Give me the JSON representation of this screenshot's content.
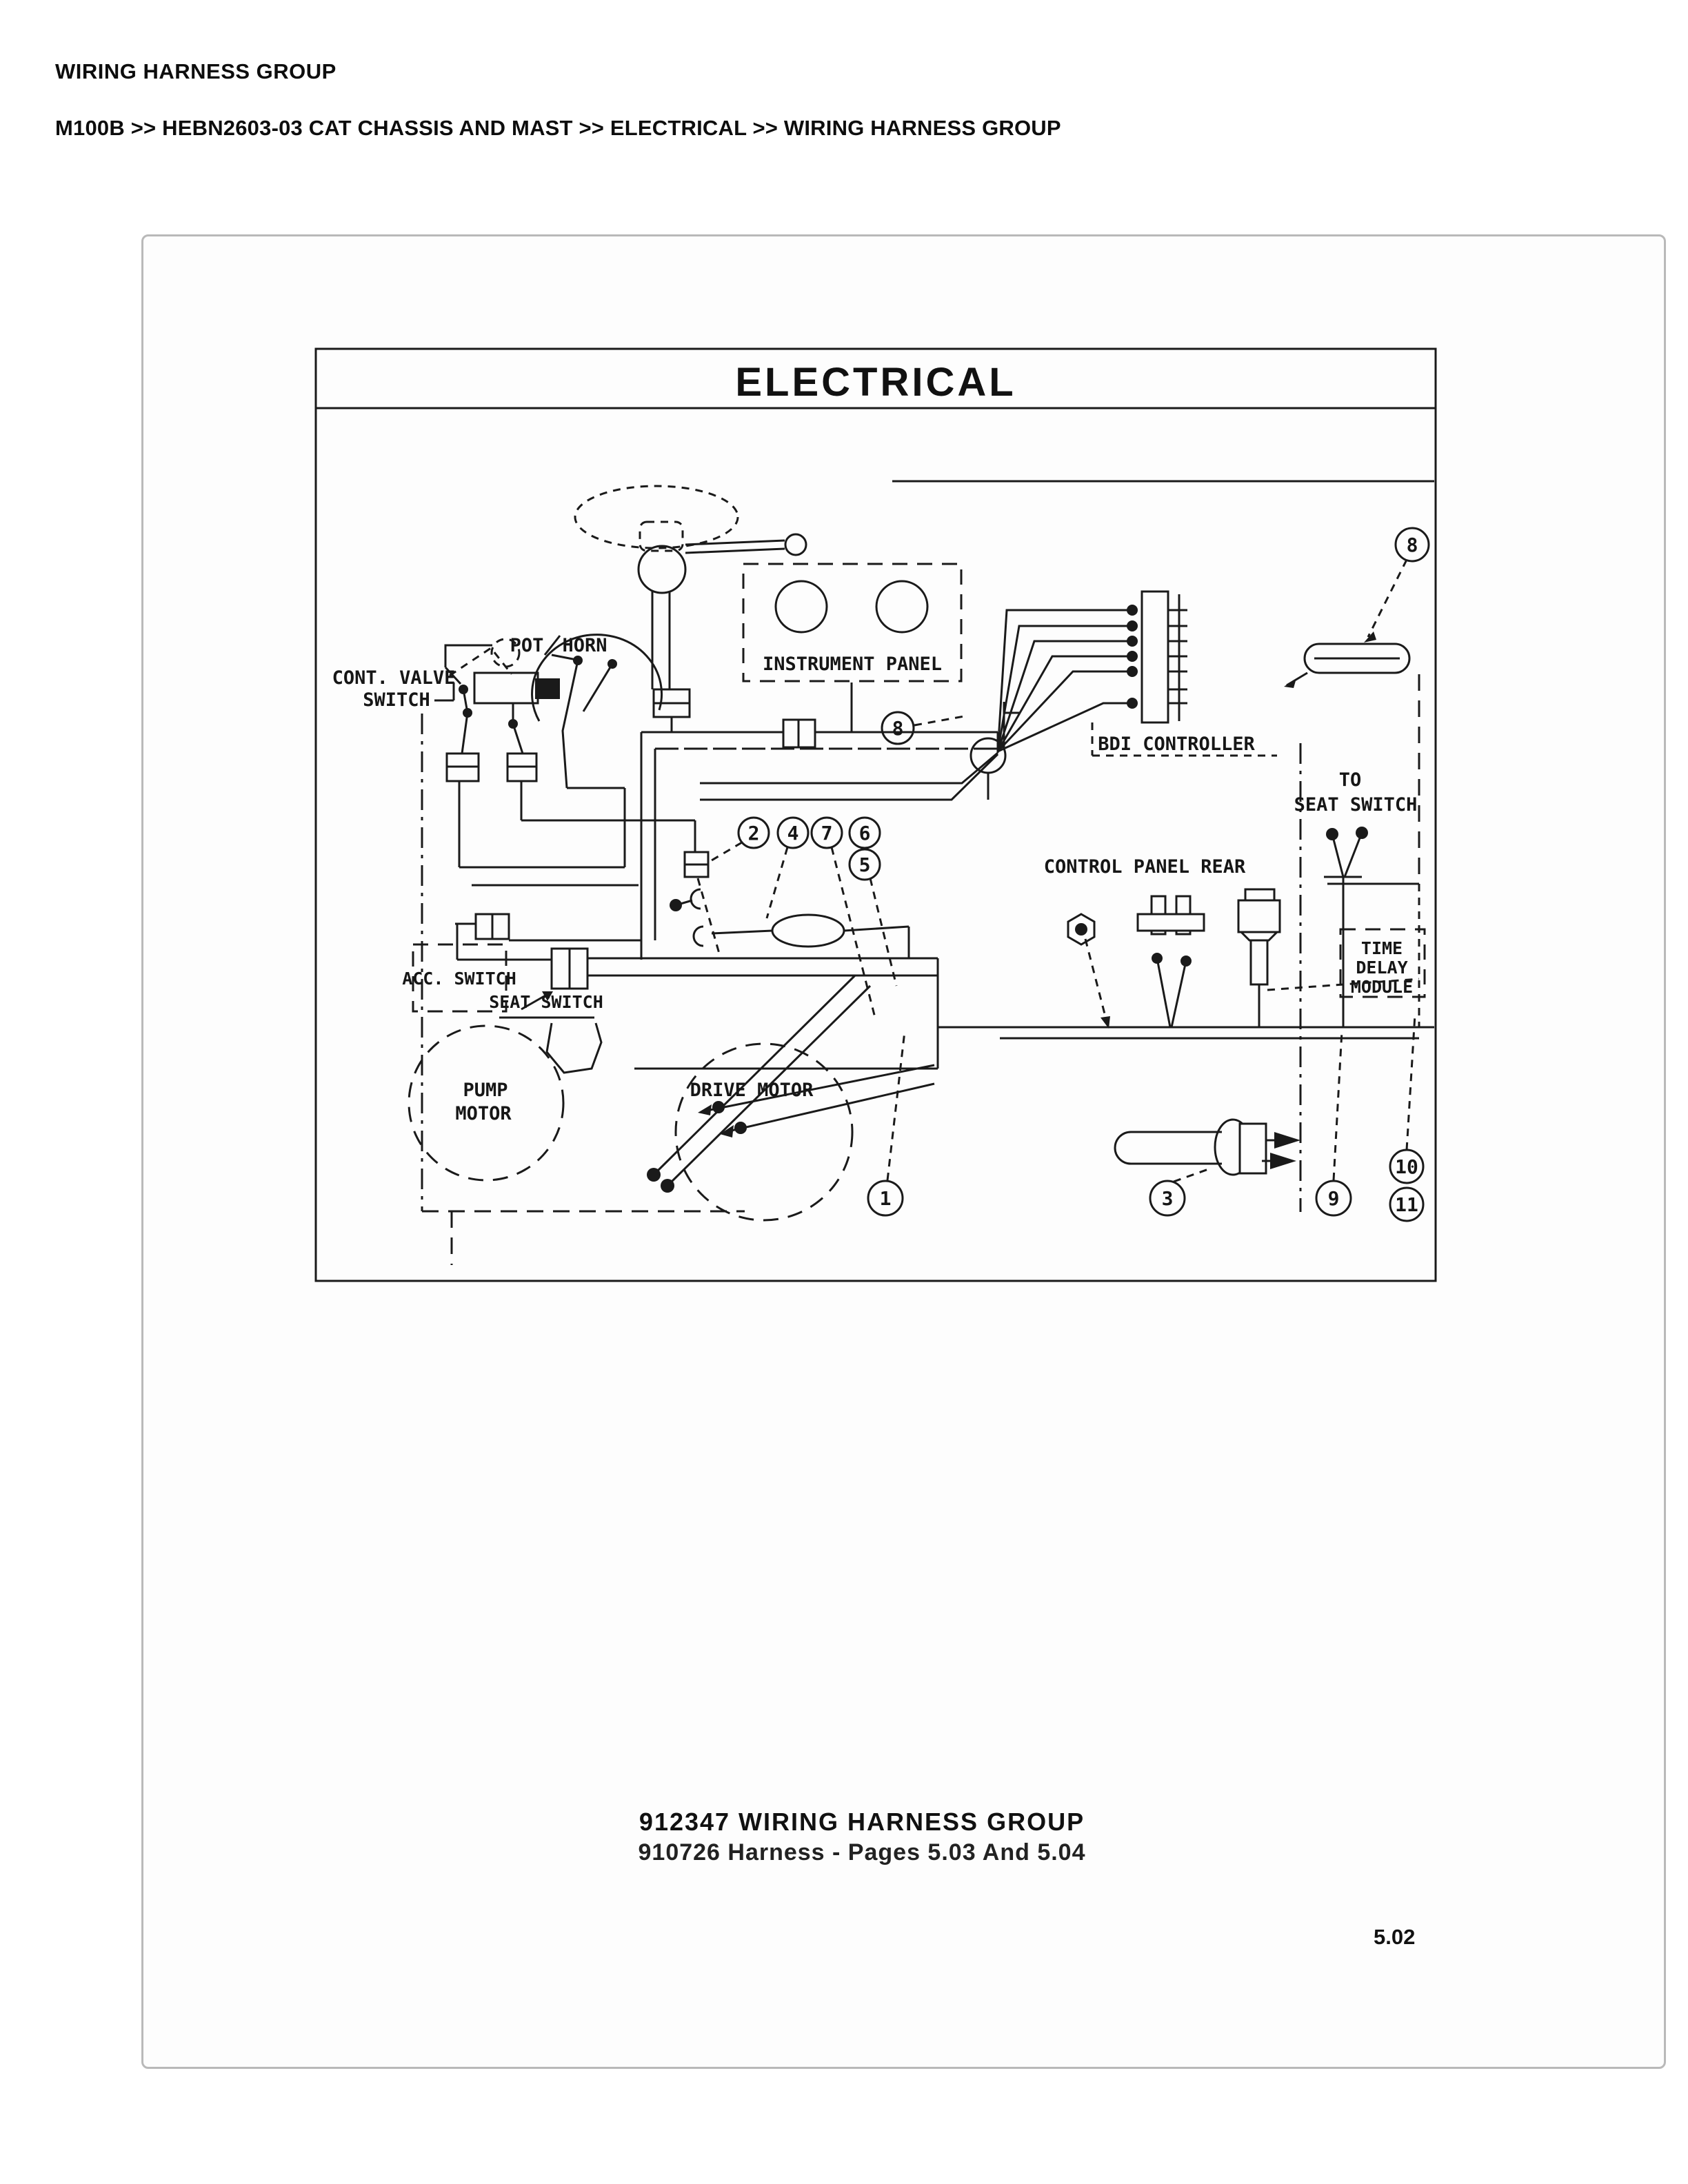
{
  "header": {
    "title": "WIRING HARNESS GROUP",
    "breadcrumb": "M100B >> HEBN2603-03 CAT CHASSIS AND MAST >> ELECTRICAL >> WIRING HARNESS GROUP"
  },
  "diagram": {
    "title": "ELECTRICAL",
    "labels": {
      "pot": "POT",
      "horn": "HORN",
      "cont_valve_1": "CONT. VALVE",
      "cont_valve_2": "SWITCH",
      "instrument_panel": "INSTRUMENT PANEL",
      "bdi_controller": "BDI CONTROLLER",
      "control_panel_rear": "CONTROL PANEL REAR",
      "to_seat_1": "TO",
      "to_seat_2": "SEAT SWITCH",
      "time_delay_1": "TIME",
      "time_delay_2": "DELAY",
      "time_delay_3": "MODULE",
      "acc_switch": "ACC. SWITCH",
      "seat_switch": "SEAT SWITCH",
      "pump_1": "PUMP",
      "pump_2": "MOTOR",
      "drive_motor": "DRIVE MOTOR"
    },
    "callouts": {
      "c1": "1",
      "c2": "2",
      "c3": "3",
      "c4": "4",
      "c5": "5",
      "c6": "6",
      "c7": "7",
      "c8_panel": "8",
      "c8_harness": "8",
      "c9": "9",
      "c10": "10",
      "c11": "11"
    }
  },
  "caption": {
    "line1": "912347 WIRING HARNESS GROUP",
    "line2": "910726 Harness - Pages 5.03 And 5.04"
  },
  "page_number": "5.02"
}
